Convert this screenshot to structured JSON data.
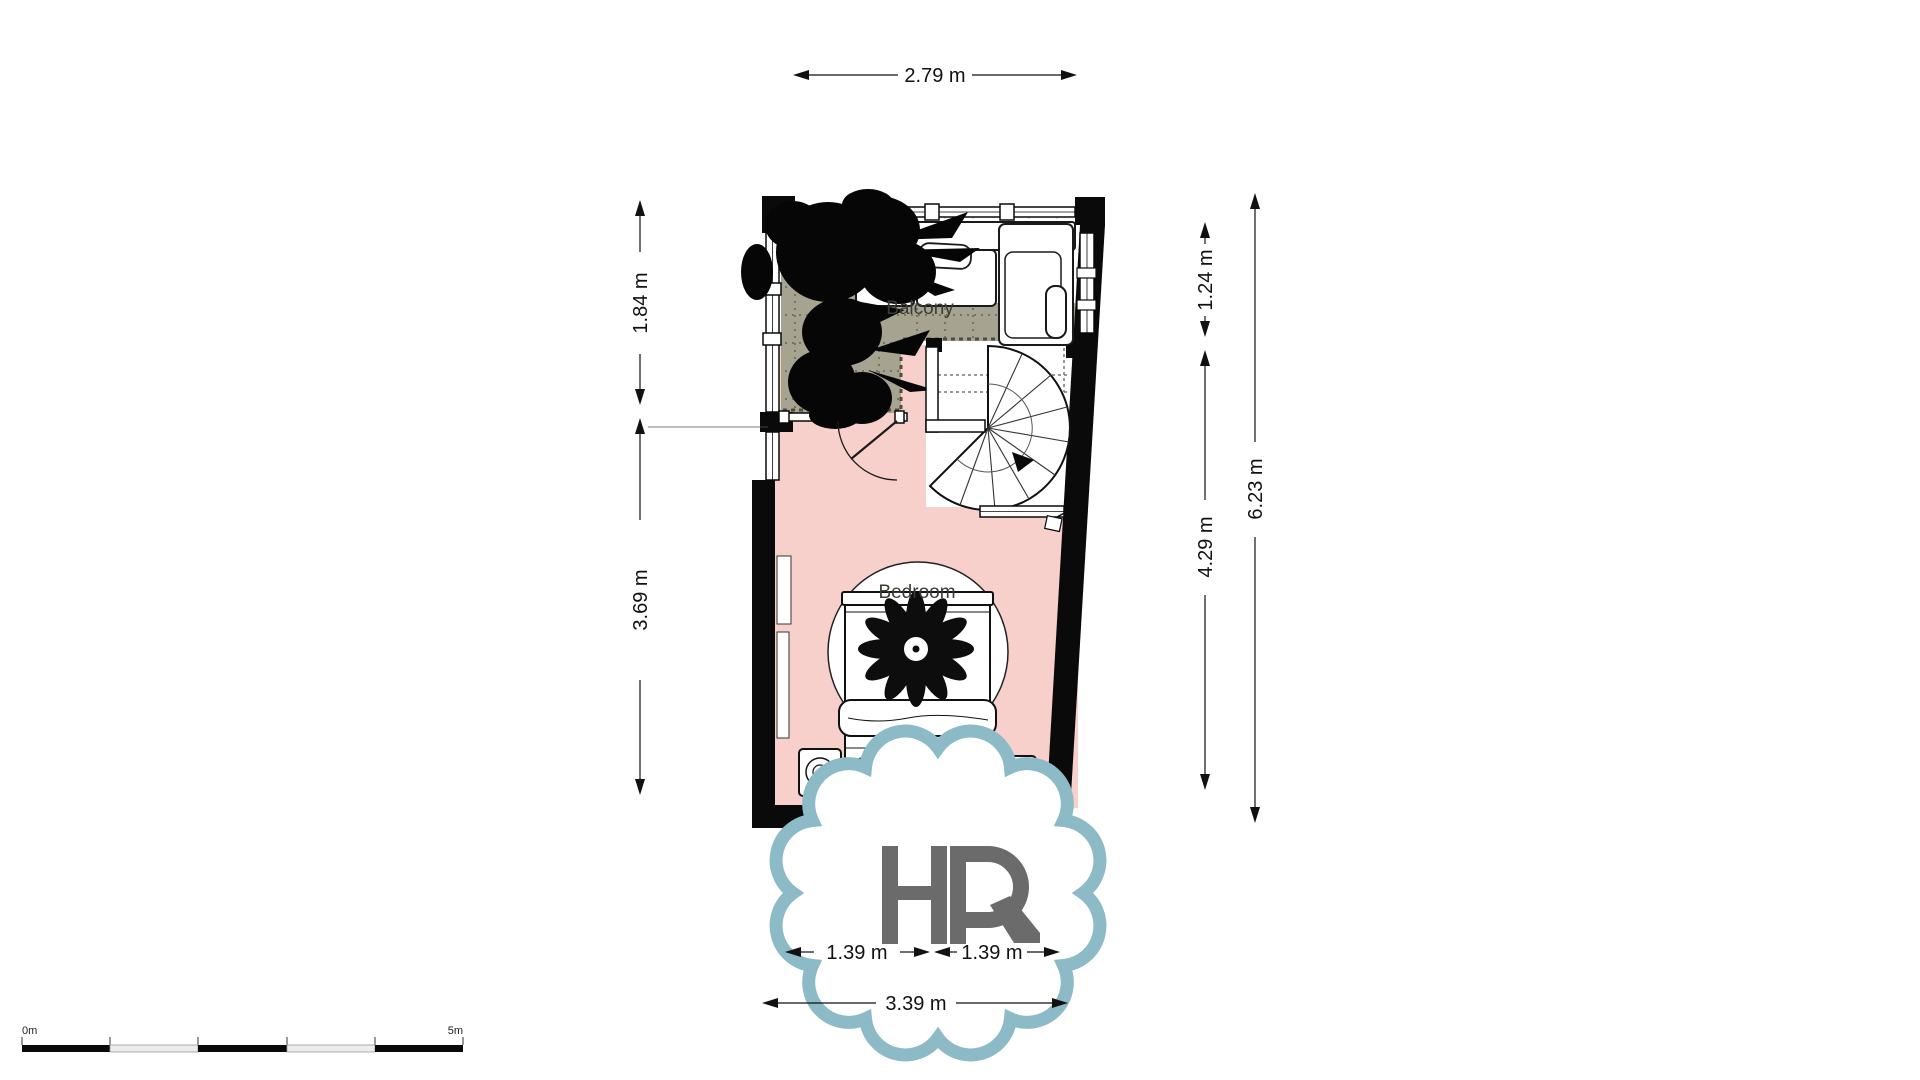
{
  "title": "Floor plan",
  "rooms": {
    "balcony": "Balcony",
    "bedroom": "Bedroom"
  },
  "dims": {
    "top": "2.79 m",
    "left_upper": "1.84 m",
    "left_lower": "3.69 m",
    "right_upper": "1.24 m",
    "right_lower": "4.29 m",
    "right_total": "6.23 m",
    "bottom_left": "1.39 m",
    "bottom_right": "1.39 m",
    "bottom_total": "3.39 m"
  },
  "watermark": {
    "text": "HR"
  },
  "scale_bar": {
    "start_label": "0m",
    "end_label": "5m",
    "segments": 5
  },
  "colors": {
    "wall": "#0a0a0a",
    "bedroom_floor": "#f8d0cb",
    "balcony_floor": "#a6a390",
    "watermark_ring": "#8cbac7",
    "watermark_letters": "#6b6b6b"
  }
}
